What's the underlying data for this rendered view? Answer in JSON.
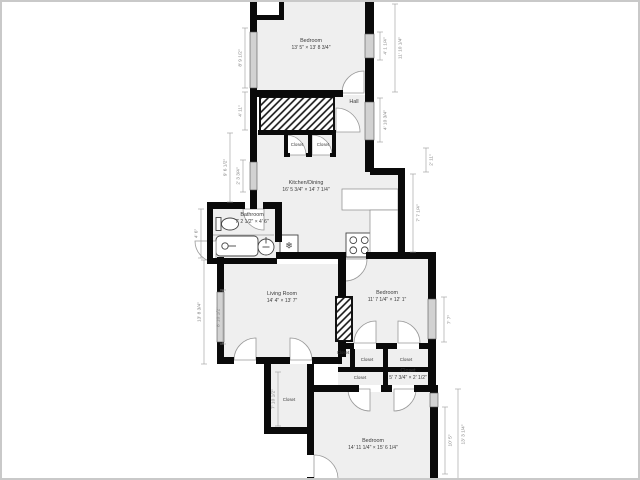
{
  "colors": {
    "background": "#ffffff",
    "wall": "#0a0a0a",
    "room_fill": "#efefef",
    "window_fill": "#d2d2d2",
    "window_stroke": "#555555",
    "door_stroke": "#999999",
    "label_color": "#3c3c3c",
    "dim_color": "#808080",
    "dim_line": "#9a9a9a",
    "fixture_stroke": "#444444",
    "hatch_color": "#111111"
  },
  "rooms": [
    {
      "name": "Bedroom",
      "dims": "13' 5\" × 13' 8 3/4\"",
      "cx": 309,
      "cy": 40
    },
    {
      "name": "Hall",
      "dims": "",
      "cx": 352,
      "cy": 99
    },
    {
      "name": "Kitchen/Dining",
      "dims": "16' 5 3/4\" × 14' 7 1/4\"",
      "cx": 304,
      "cy": 182
    },
    {
      "name": "Bathroom",
      "dims": "7' 2 1/2\" × 4' 6\"",
      "cx": 250,
      "cy": 214
    },
    {
      "name": "Living Room",
      "dims": "14' 4\" × 13' 7\"",
      "cx": 280,
      "cy": 293
    },
    {
      "name": "Bedroom",
      "dims": "11' 7 1/4\" × 12' 1\"",
      "cx": 385,
      "cy": 292
    },
    {
      "name": "Closet",
      "dims": "5' 7 3/4\" × 2' 1/2\"",
      "cx": 406,
      "cy": 370
    },
    {
      "name": "Bedroom",
      "dims": "14' 11 1/4\" × 15' 6 1/4\"",
      "cx": 371,
      "cy": 440
    }
  ],
  "closet_labels": [
    {
      "label": "Closet",
      "cx": 295,
      "cy": 142
    },
    {
      "label": "Closet",
      "cx": 321,
      "cy": 142
    },
    {
      "label": "Closet",
      "cx": 341,
      "cy": 350
    },
    {
      "label": "Closet",
      "cx": 365,
      "cy": 357
    },
    {
      "label": "Closet",
      "cx": 404,
      "cy": 357
    },
    {
      "label": "Closet",
      "cx": 358,
      "cy": 375
    },
    {
      "label": "Closet",
      "cx": 287,
      "cy": 397
    }
  ],
  "dimensions": {
    "left": [
      {
        "text": "8' 9 1/2\"",
        "x": 243,
        "y1": 26,
        "y2": 86
      },
      {
        "text": "4' 11\"",
        "x": 243,
        "y1": 90,
        "y2": 128
      },
      {
        "text": "9' 6 1/2\"",
        "x": 228,
        "y1": 131,
        "y2": 200
      },
      {
        "text": "2' 3 3/4\"",
        "x": 241,
        "y1": 158,
        "y2": 190
      },
      {
        "text": "4' 6\"",
        "x": 199,
        "y1": 207,
        "y2": 256
      },
      {
        "text": "13' 8 3/4\"",
        "x": 202,
        "y1": 258,
        "y2": 362
      },
      {
        "text": "8' 10 1/2\"",
        "x": 221,
        "y1": 288,
        "y2": 342
      },
      {
        "text": "7' 10 1/2\"",
        "x": 276,
        "y1": 370,
        "y2": 424
      }
    ],
    "right": [
      {
        "text": "4' 1 1/4\"",
        "x": 378,
        "y1": 30,
        "y2": 58
      },
      {
        "text": "11' 10 1/4\"",
        "x": 393,
        "y1": 2,
        "y2": 90
      },
      {
        "text": "4' 10 3/4\"",
        "x": 378,
        "y1": 96,
        "y2": 140
      },
      {
        "text": "2' 11\"",
        "x": 424,
        "y1": 146,
        "y2": 170
      },
      {
        "text": "7' 7 1/4\"",
        "x": 411,
        "y1": 172,
        "y2": 250
      },
      {
        "text": "7' 7\"",
        "x": 442,
        "y1": 295,
        "y2": 340
      },
      {
        "text": "10' 5\"",
        "x": 443,
        "y1": 405,
        "y2": 472
      },
      {
        "text": "13' 3 1/4\"",
        "x": 456,
        "y1": 387,
        "y2": 478
      }
    ]
  },
  "geometry": {
    "fills": [
      [
        255,
        0,
        108,
        90
      ],
      [
        332,
        93,
        31,
        75
      ],
      [
        252,
        131,
        120,
        36
      ],
      [
        252,
        166,
        144,
        91
      ],
      [
        211,
        207,
        62,
        50
      ],
      [
        222,
        262,
        114,
        93
      ],
      [
        344,
        257,
        82,
        84
      ],
      [
        336,
        347,
        90,
        36
      ],
      [
        269,
        362,
        36,
        63
      ],
      [
        312,
        390,
        116,
        90
      ]
    ],
    "white_patches": [
      [
        255,
        0,
        22,
        13
      ]
    ],
    "hatches": [
      [
        258,
        95,
        74,
        36
      ],
      [
        334,
        295,
        16,
        44
      ]
    ],
    "walls": [
      [
        248,
        0,
        7,
        95
      ],
      [
        255,
        13,
        27,
        5
      ],
      [
        277,
        0,
        5,
        16
      ],
      [
        363,
        0,
        9,
        170
      ],
      [
        248,
        88,
        93,
        7
      ],
      [
        248,
        95,
        7,
        112
      ],
      [
        256,
        128,
        78,
        5
      ],
      [
        282,
        133,
        4,
        22
      ],
      [
        306,
        133,
        4,
        22
      ],
      [
        330,
        133,
        4,
        22
      ],
      [
        282,
        151,
        6,
        4
      ],
      [
        304,
        151,
        6,
        4
      ],
      [
        328,
        151,
        6,
        4
      ],
      [
        205,
        200,
        38,
        7
      ],
      [
        261,
        200,
        19,
        7
      ],
      [
        205,
        200,
        6,
        62
      ],
      [
        205,
        256,
        70,
        6
      ],
      [
        273,
        200,
        7,
        40
      ],
      [
        368,
        166,
        35,
        7
      ],
      [
        396,
        166,
        7,
        91
      ],
      [
        274,
        250,
        68,
        7
      ],
      [
        364,
        250,
        69,
        7
      ],
      [
        215,
        255,
        7,
        107
      ],
      [
        215,
        355,
        17,
        7
      ],
      [
        254,
        355,
        34,
        7
      ],
      [
        310,
        355,
        30,
        7
      ],
      [
        336,
        250,
        8,
        45
      ],
      [
        336,
        339,
        8,
        16
      ],
      [
        336,
        341,
        16,
        6
      ],
      [
        374,
        341,
        21,
        6
      ],
      [
        417,
        341,
        16,
        6
      ],
      [
        348,
        347,
        5,
        18
      ],
      [
        381,
        347,
        5,
        18
      ],
      [
        336,
        365,
        97,
        5
      ],
      [
        381,
        370,
        5,
        13
      ],
      [
        312,
        383,
        45,
        7
      ],
      [
        379,
        383,
        11,
        7
      ],
      [
        412,
        383,
        21,
        7
      ],
      [
        262,
        355,
        7,
        77
      ],
      [
        305,
        362,
        7,
        91
      ],
      [
        305,
        475,
        7,
        5
      ],
      [
        262,
        425,
        50,
        7
      ],
      [
        426,
        250,
        8,
        140
      ],
      [
        428,
        383,
        8,
        97
      ]
    ],
    "windows": [
      [
        248,
        30,
        7,
        56
      ],
      [
        363,
        32,
        9,
        24
      ],
      [
        363,
        100,
        9,
        38
      ],
      [
        248,
        160,
        7,
        28
      ],
      [
        215,
        290,
        7,
        50
      ],
      [
        426,
        297,
        8,
        40
      ],
      [
        428,
        391,
        8,
        14
      ]
    ],
    "doors": [
      {
        "cx": 362,
        "cy": 91,
        "r": 22,
        "a1": 180,
        "a2": 270
      },
      {
        "cx": 334,
        "cy": 130,
        "r": 24,
        "a1": 270,
        "a2": 360
      },
      {
        "cx": 284,
        "cy": 153,
        "r": 20,
        "a1": 270,
        "a2": 360
      },
      {
        "cx": 310,
        "cy": 153,
        "r": 20,
        "a1": 270,
        "a2": 360
      },
      {
        "cx": 262,
        "cy": 207,
        "r": 21,
        "a1": 90,
        "a2": 180
      },
      {
        "cx": 214,
        "cy": 239,
        "r": 21,
        "a1": 90,
        "a2": 180
      },
      {
        "cx": 343,
        "cy": 257,
        "r": 22,
        "a1": 0,
        "a2": 90
      },
      {
        "cx": 254,
        "cy": 358,
        "r": 22,
        "a1": 180,
        "a2": 270
      },
      {
        "cx": 288,
        "cy": 358,
        "r": 22,
        "a1": 270,
        "a2": 360
      },
      {
        "cx": 374,
        "cy": 341,
        "r": 22,
        "a1": 180,
        "a2": 270
      },
      {
        "cx": 396,
        "cy": 341,
        "r": 22,
        "a1": 270,
        "a2": 360
      },
      {
        "cx": 368,
        "cy": 387,
        "r": 22,
        "a1": 90,
        "a2": 180
      },
      {
        "cx": 392,
        "cy": 387,
        "r": 22,
        "a1": 0,
        "a2": 90
      },
      {
        "cx": 312,
        "cy": 477,
        "r": 24,
        "a1": 270,
        "a2": 360
      }
    ],
    "fixtures": [
      {
        "type": "toilet",
        "x": 228,
        "y": 222
      },
      {
        "type": "tub",
        "x": 214,
        "y": 234,
        "w": 42,
        "h": 20
      },
      {
        "type": "sink",
        "x": 264,
        "y": 245,
        "r": 8
      },
      {
        "type": "fridge",
        "x": 278,
        "y": 233,
        "w": 18,
        "h": 21
      },
      {
        "type": "stove",
        "x": 344,
        "y": 231,
        "w": 26,
        "h": 24
      },
      {
        "type": "counter",
        "x": 340,
        "y": 187,
        "w": 56,
        "h": 21
      },
      {
        "type": "counter",
        "x": 368,
        "y": 208,
        "w": 28,
        "h": 46
      }
    ],
    "lines": [
      [
        211,
        233,
        272,
        233
      ]
    ]
  },
  "icons": {
    "fridge_glyph": "❄"
  }
}
